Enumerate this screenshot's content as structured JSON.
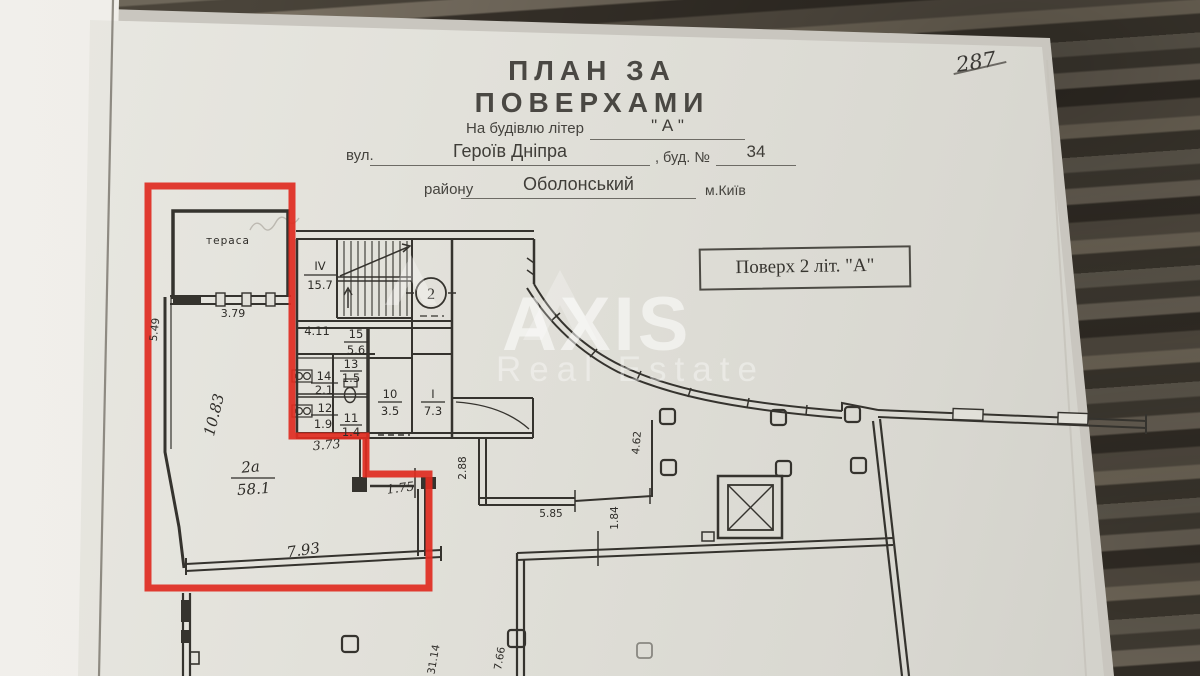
{
  "photo": {
    "page_number": "287"
  },
  "header": {
    "title": "ПЛАН ЗА ПОВЕРХАМИ",
    "building_label": "На будівлю літер",
    "building_value": "\" А \"",
    "street_label": "вул.",
    "street_value": "Героїв Дніпра",
    "house_label": ", буд. №",
    "house_value": "34",
    "district_label": "району",
    "district_value": "Оболонський",
    "city_label": "м.Київ",
    "floor_badge": "Поверх 2 літ. \"А\""
  },
  "watermark": {
    "brand": "AXIS",
    "tagline": "Real Estate"
  },
  "plan": {
    "terrace_label": "тераса",
    "stair_floor_number": "2",
    "rooms": {
      "r4": {
        "no": "IV",
        "area": "15.7"
      },
      "r15": {
        "no": "15",
        "area": "5.6"
      },
      "r14": {
        "no": "14",
        "area": "2.1"
      },
      "r13": {
        "no": "13",
        "area": "1.5"
      },
      "r12": {
        "no": "12",
        "area": "1.9"
      },
      "r11": {
        "no": "11",
        "area": "1.4"
      },
      "r10": {
        "no": "10",
        "area": "3.5"
      },
      "r1": {
        "no": "I",
        "area": "7.3"
      },
      "r2a": {
        "no": "2а",
        "area": "58.1"
      }
    },
    "dims": {
      "d379": "3.79",
      "d549": "5.49",
      "d1083": "10.83",
      "d411": "4.11",
      "d373": "3.73",
      "d793": "7.93",
      "d175": "1.75",
      "d288": "2.88",
      "d585": "5.85",
      "d184": "1.84",
      "d462": "4.62",
      "d3114": "31.14",
      "d766": "7.66"
    }
  },
  "colors": {
    "highlight": "#df2b21",
    "ink": "#35332e"
  }
}
